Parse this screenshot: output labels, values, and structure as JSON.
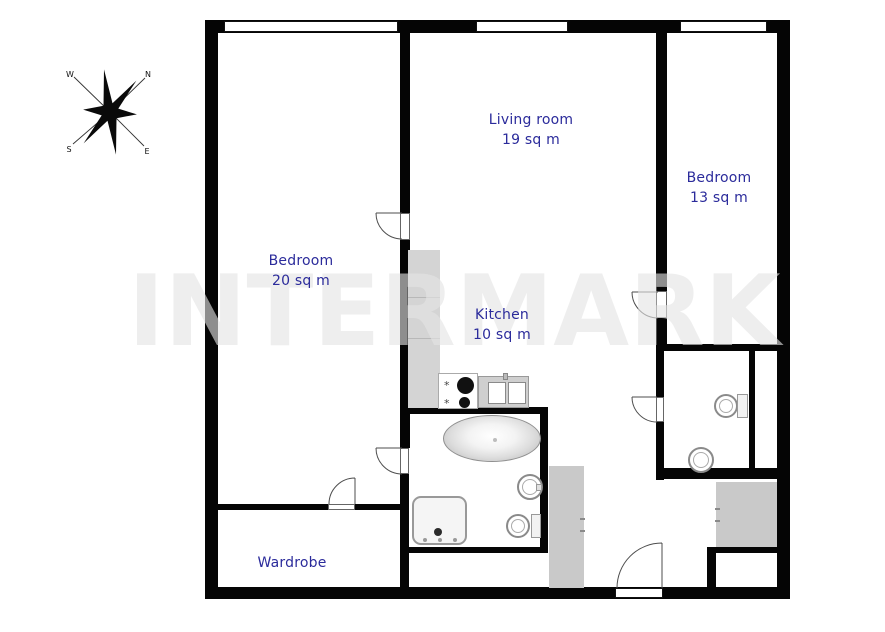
{
  "watermark": "INTERMARK",
  "rooms": [
    {
      "name": "Living room",
      "area": "19 sq m"
    },
    {
      "name": "Bedroom",
      "area": "13 sq m"
    },
    {
      "name": "Bedroom",
      "area": "20 sq m"
    },
    {
      "name": "Kitchen",
      "area": "10 sq m"
    },
    {
      "name": "Wardrobe"
    }
  ],
  "compass": {
    "north": "N",
    "east": "E",
    "south": "S",
    "west": "W"
  },
  "icons": {
    "gas_burner_mark": "*"
  },
  "colors": {
    "wall": "#050505",
    "room_label": "#2b2b9b",
    "kitchen_counter": "#d4d4d4",
    "hall_cabinet": "#c9c9c9",
    "watermark": "#e4e4e4"
  }
}
